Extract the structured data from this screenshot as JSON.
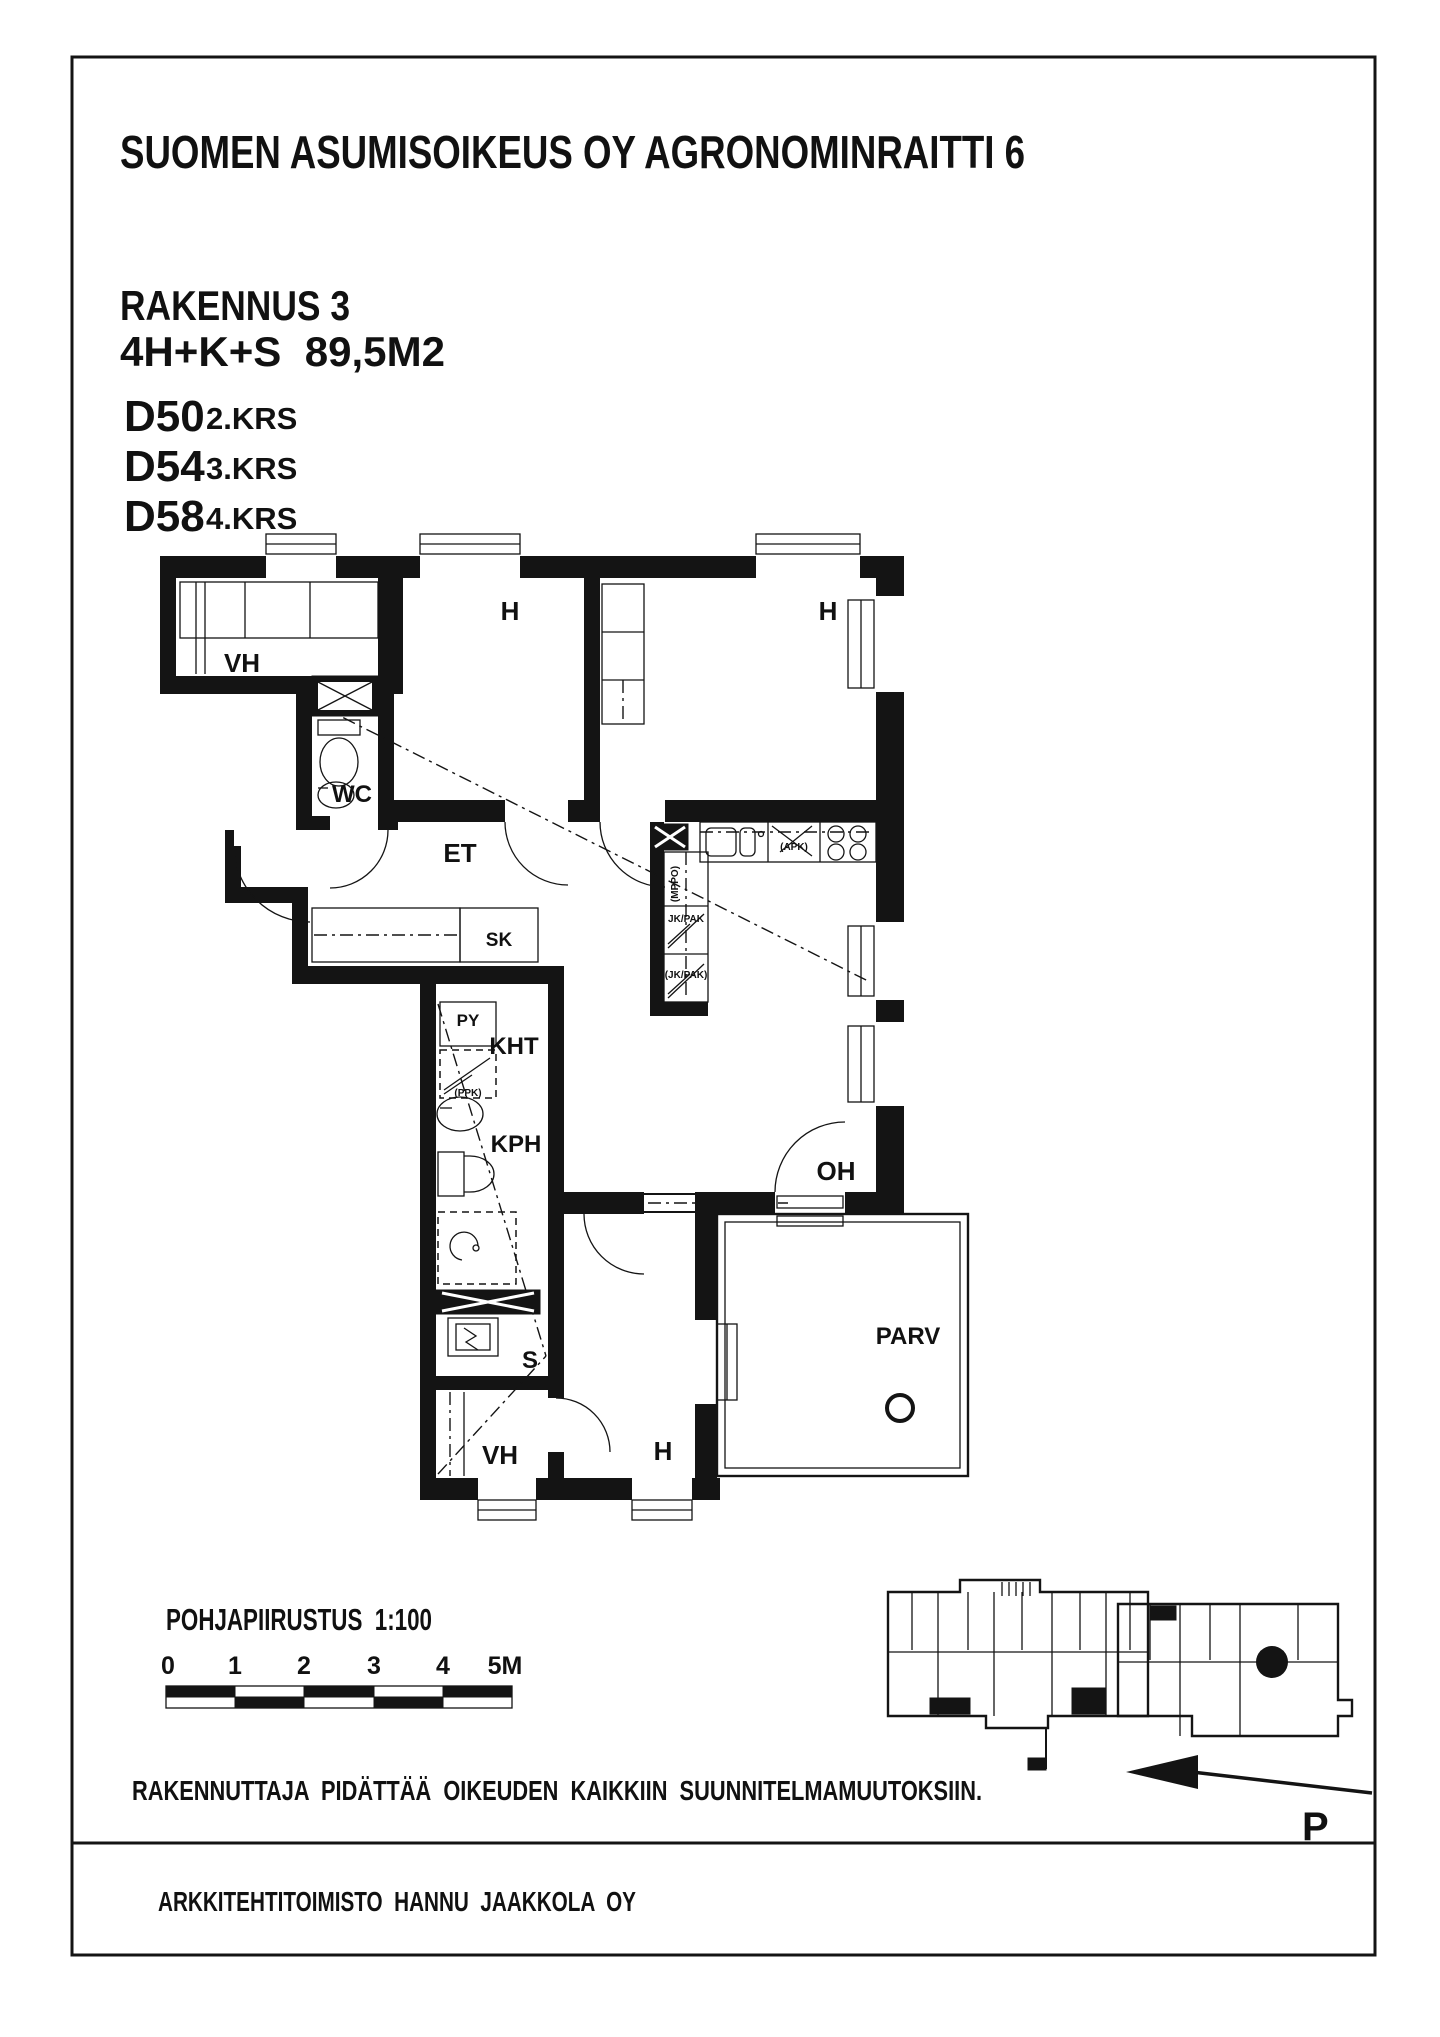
{
  "header": {
    "title": "SUOMEN ASUMISOIKEUS OY AGRONOMINRAITTI 6",
    "building": "RAKENNUS 3",
    "apartment_type": "4H+K+S  89,5M2",
    "units": [
      {
        "id": "D50",
        "floor": "2.KRS"
      },
      {
        "id": "D54",
        "floor": "3.KRS"
      },
      {
        "id": "D58",
        "floor": "4.KRS"
      }
    ]
  },
  "floorplan": {
    "rooms": {
      "vh_top": "VH",
      "h_top_left": "H",
      "h_top_right": "H",
      "wc": "WC",
      "et": "ET",
      "sk": "SK",
      "py": "PY",
      "kht": "KHT",
      "kph": "KPH",
      "sauna": "S",
      "vh_bottom": "VH",
      "h_bottom": "H",
      "oh": "OH",
      "parv": "PARV"
    },
    "appliances": {
      "apk": "(APK)",
      "jk_pak": "JK/PAK",
      "jk_pak_reserved": "(JK/PAK)",
      "mppo": "(MPPO)",
      "ppk": "(PPK)"
    }
  },
  "scale_block": {
    "drawing_label": "POHJAPIIRUSTUS  1:100",
    "ticks": [
      "0",
      "1",
      "2",
      "3",
      "4",
      "5M"
    ]
  },
  "notes": {
    "disclaimer": "RAKENNUTTAJA  PIDÄTTÄÄ  OIKEUDEN  KAIKKIIN  SUUNNITELMAMUUTOKSIIN.",
    "architect": "ARKKITEHTITOIMISTO  HANNU  JAAKKOLA  OY",
    "north": "P"
  }
}
